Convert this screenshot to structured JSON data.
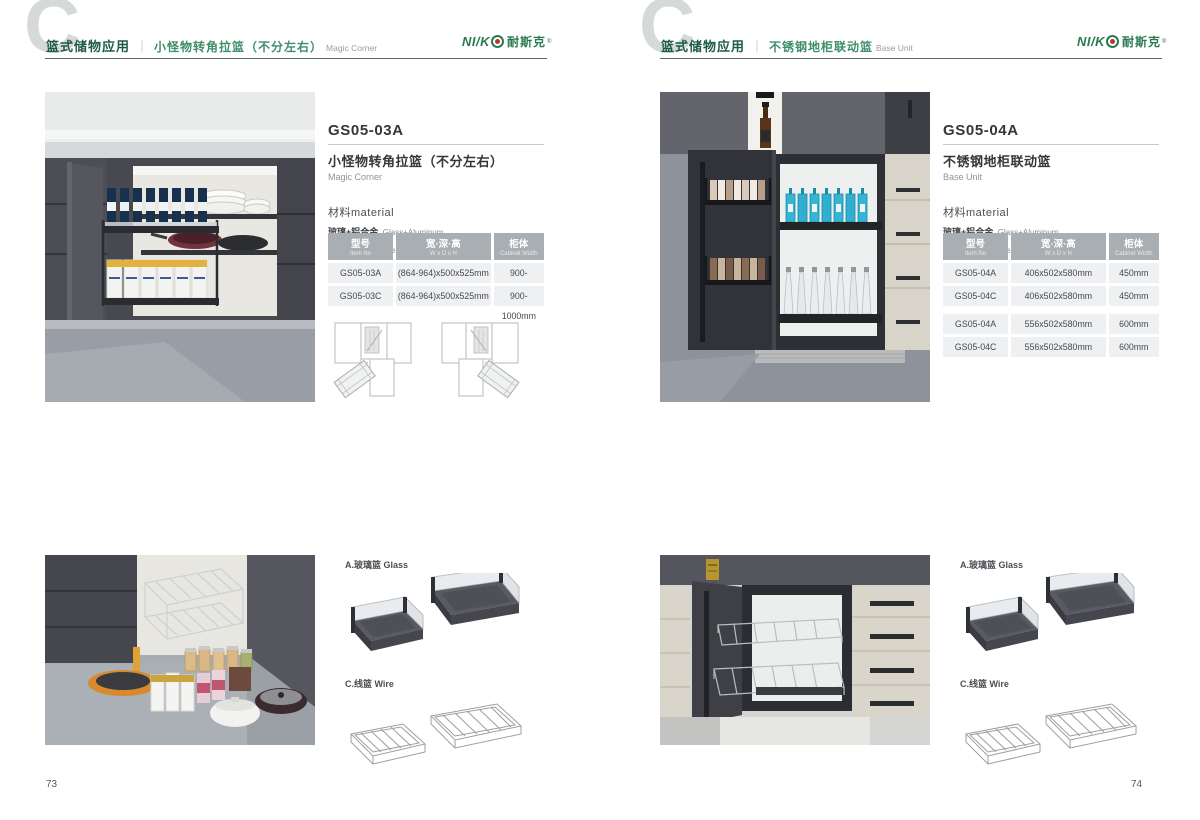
{
  "brand": {
    "logo_prefix": "NI/K",
    "logo_cn": "耐斯克",
    "registered_mark": "®",
    "logo_color": "#2a7a50"
  },
  "pages": [
    {
      "page_number": "73",
      "header": {
        "watermark_letter": "C",
        "category_cn": "篮式储物应用",
        "divider": "｜",
        "subtitle_cn": "小怪物转角拉篮（不分左右）",
        "subtitle_en": "Magic Corner"
      },
      "product": {
        "model": "GS05-03A",
        "name_cn": "小怪物转角拉篮（不分左右）",
        "name_en": "Magic Corner",
        "material_heading": "材料material",
        "materials": [
          {
            "cn": "玻璃+铝合金",
            "en": "Glass+Aluminum"
          },
          {
            "cn": "不锈钢/铁",
            "en": "Stainless SteeL/Iron"
          }
        ]
      },
      "spec_table": {
        "headers": [
          {
            "cn": "型号",
            "en": "Item No"
          },
          {
            "cn": "宽·深·高",
            "en": "W x D x H"
          },
          {
            "cn": "柜体",
            "en": "Cabinet Width"
          }
        ],
        "rows": [
          [
            "GS05-03A",
            "(864-964)x500x525mm",
            "900-1000mm"
          ],
          [
            "GS05-03C",
            "(864-964)x500x525mm",
            "900-1000mm"
          ]
        ]
      },
      "accessories": {
        "glass_label": "A.玻璃篮 Glass",
        "wire_label": "C.线篮 Wire"
      }
    },
    {
      "page_number": "74",
      "header": {
        "watermark_letter": "C",
        "category_cn": "篮式储物应用",
        "divider": "｜",
        "subtitle_cn": "不锈钢地柜联动篮",
        "subtitle_en": "Base Unit"
      },
      "product": {
        "model": "GS05-04A",
        "name_cn": "不锈钢地柜联动篮",
        "name_en": "Base Unit",
        "material_heading": "材料material",
        "materials": [
          {
            "cn": "玻璃+铝合金",
            "en": "Glass+Aluminum"
          },
          {
            "cn": "不锈钢/铁",
            "en": "Stainless SteeL/Iron"
          }
        ]
      },
      "spec_table": {
        "headers": [
          {
            "cn": "型号",
            "en": "Item No"
          },
          {
            "cn": "宽·深·高",
            "en": "W x D x H"
          },
          {
            "cn": "柜体",
            "en": "Cabinet Width"
          }
        ],
        "rows": [
          [
            "GS05-04A",
            "406x502x580mm",
            "450mm"
          ],
          [
            "GS05-04C",
            "406x502x580mm",
            "450mm"
          ],
          [
            "GS05-04A",
            "556x502x580mm",
            "600mm"
          ],
          [
            "GS05-04C",
            "556x502x580mm",
            "600mm"
          ]
        ]
      },
      "accessories": {
        "glass_label": "A.玻璃篮 Glass",
        "wire_label": "C.线篮 Wire"
      }
    }
  ]
}
